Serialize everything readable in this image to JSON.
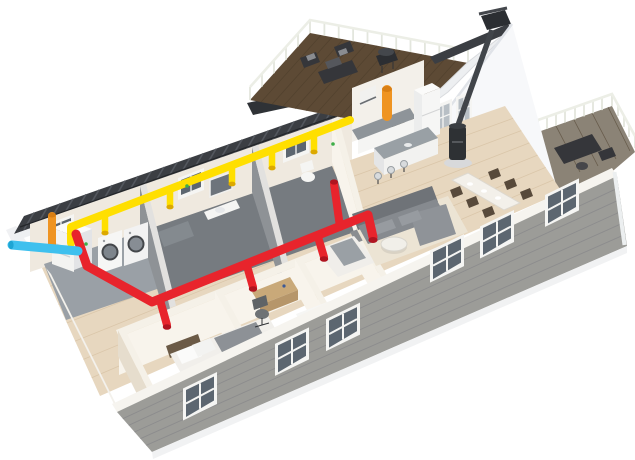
{
  "colors": {
    "background": "#ffffff",
    "supply_duct": "#ffdf00",
    "supply_valve_cap": "#dca900",
    "extract_duct": "#e8242c",
    "extract_valve_cap": "#b01420",
    "fresh_air_intake_duct": "#ef9422",
    "intake_cap": "#d97f14",
    "exhaust_air_duct": "#3ec0ee",
    "exhaust_cap": "#1ea5d4",
    "kitchen_vent_duct": "#ef9422",
    "roof_dark": "#3b3e43",
    "deck_wood": "#5d4a35",
    "siding_gray": "#9c9c98",
    "interior_wall": "#f8f4ec",
    "wood_floor": "#e7d7bf",
    "bathroom_gray": "#767b80",
    "tech_floor_gray": "#9aa0a6",
    "window_glass": "#5c6670",
    "window_frame": "#f5f5f3",
    "sofa_gray": "#868a8f",
    "stove_black": "#2e3134",
    "outdoor_furniture": "#35363a",
    "status_led": "#3fae49",
    "gable_white": "#f7f8fa",
    "porch_deck": "#8b8376"
  }
}
